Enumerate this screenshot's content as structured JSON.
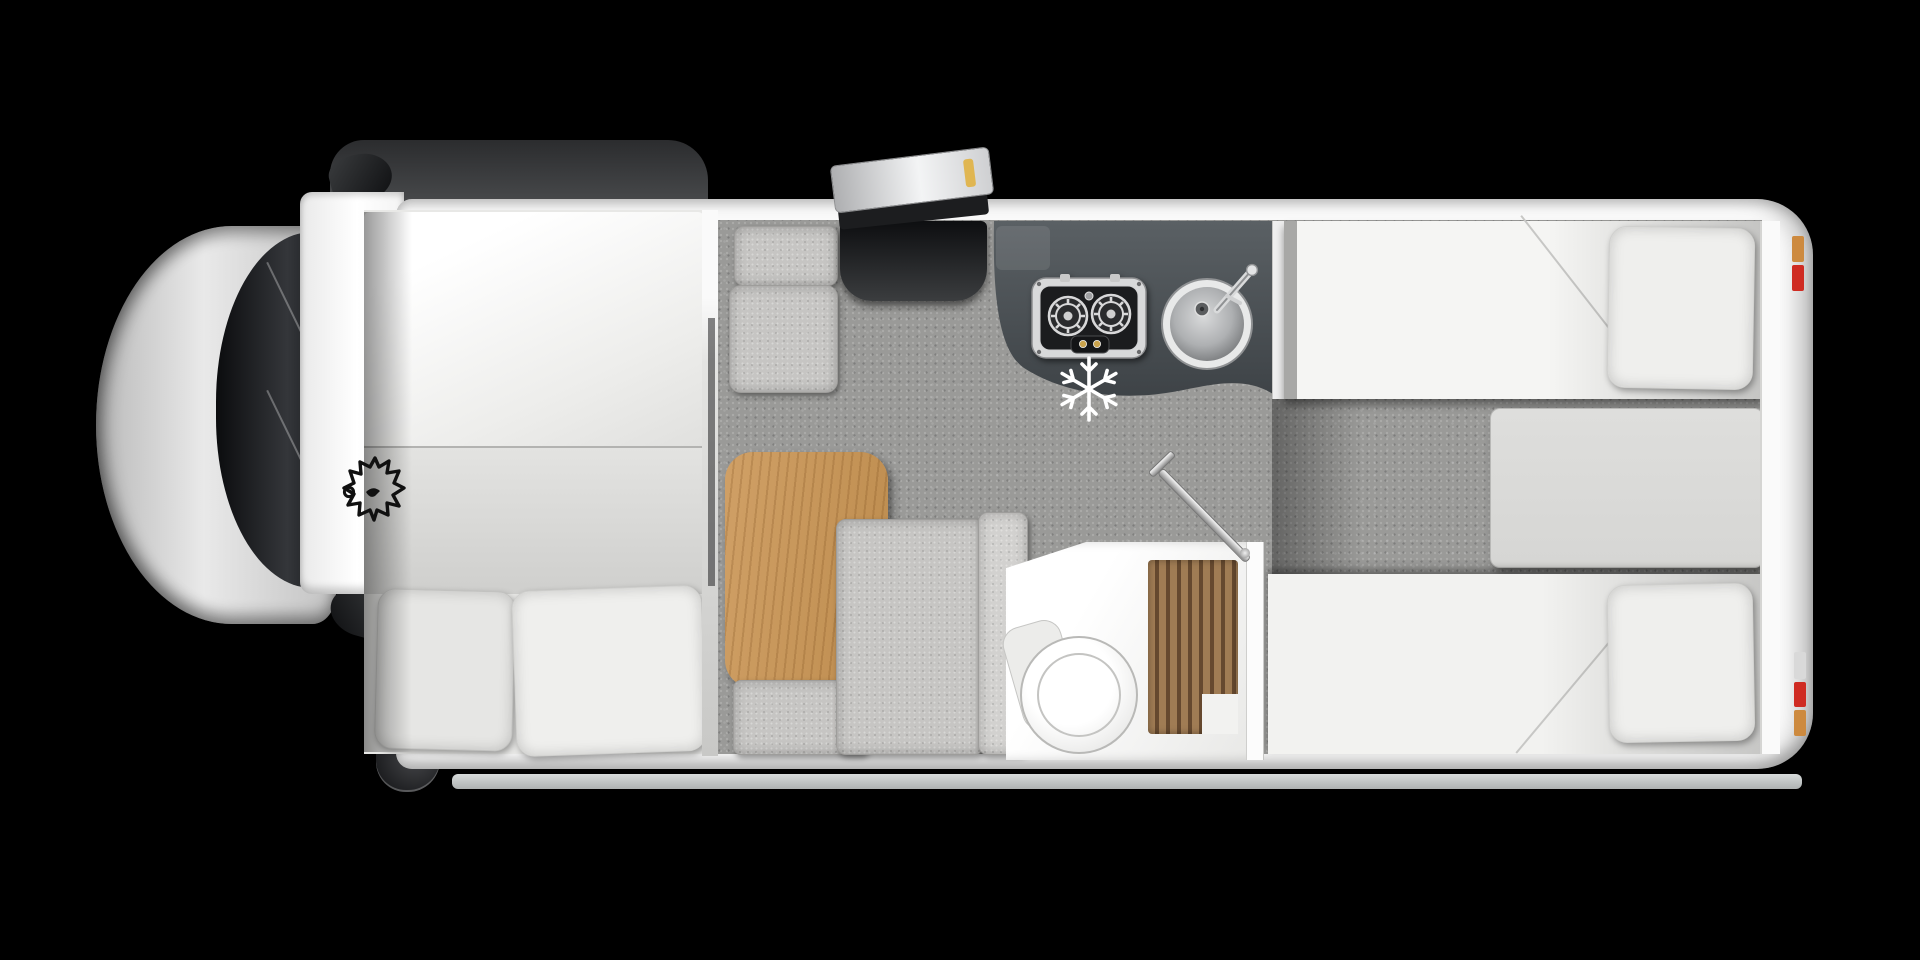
{
  "meta": {
    "description": "Top-down photographic floorplan of a coachbuilt motorhome on a black background",
    "canvas": {
      "width": 1920,
      "height": 960
    }
  },
  "colors": {
    "bg": "#000000",
    "body": "#fbfbfb",
    "carpet": "#9a9a98",
    "cushion": "#c6c5c3",
    "worktop-top": "#5a6064",
    "worktop-bottom": "#3e4347",
    "table-wood-1": "#d0a066",
    "table-wood-2": "#bd8c4e",
    "chest": "#d6d6d4",
    "bedding": "#f5f5f3",
    "pillow": "#efefed",
    "shower-wood-1": "#a07c54",
    "shower-wood-2": "#66492f",
    "cab-silver-1": "#cfcfcf",
    "cab-silver-2": "#e9e9e9",
    "glass-dark": "#141619",
    "skirt": "#c7cbcb",
    "light-red": "#cf2b22",
    "light-amber": "#cd8a3f",
    "skylight-amber": "#e0b652",
    "snowflake": "#ffffff",
    "leaf-outline": "#101010"
  },
  "icons": {
    "maple_leaf": "maple-leaf-icon",
    "snowflake": "snowflake-icon"
  },
  "areas": {
    "cab": "driving cab",
    "overcab_bed": "front transverse double bed",
    "lounge": "half-dinette lounge with table",
    "kitchen": "kitchen with two-burner hob and sink",
    "bathroom": "washroom with toilet and shower",
    "rear_bedroom": "rear twin single beds"
  }
}
